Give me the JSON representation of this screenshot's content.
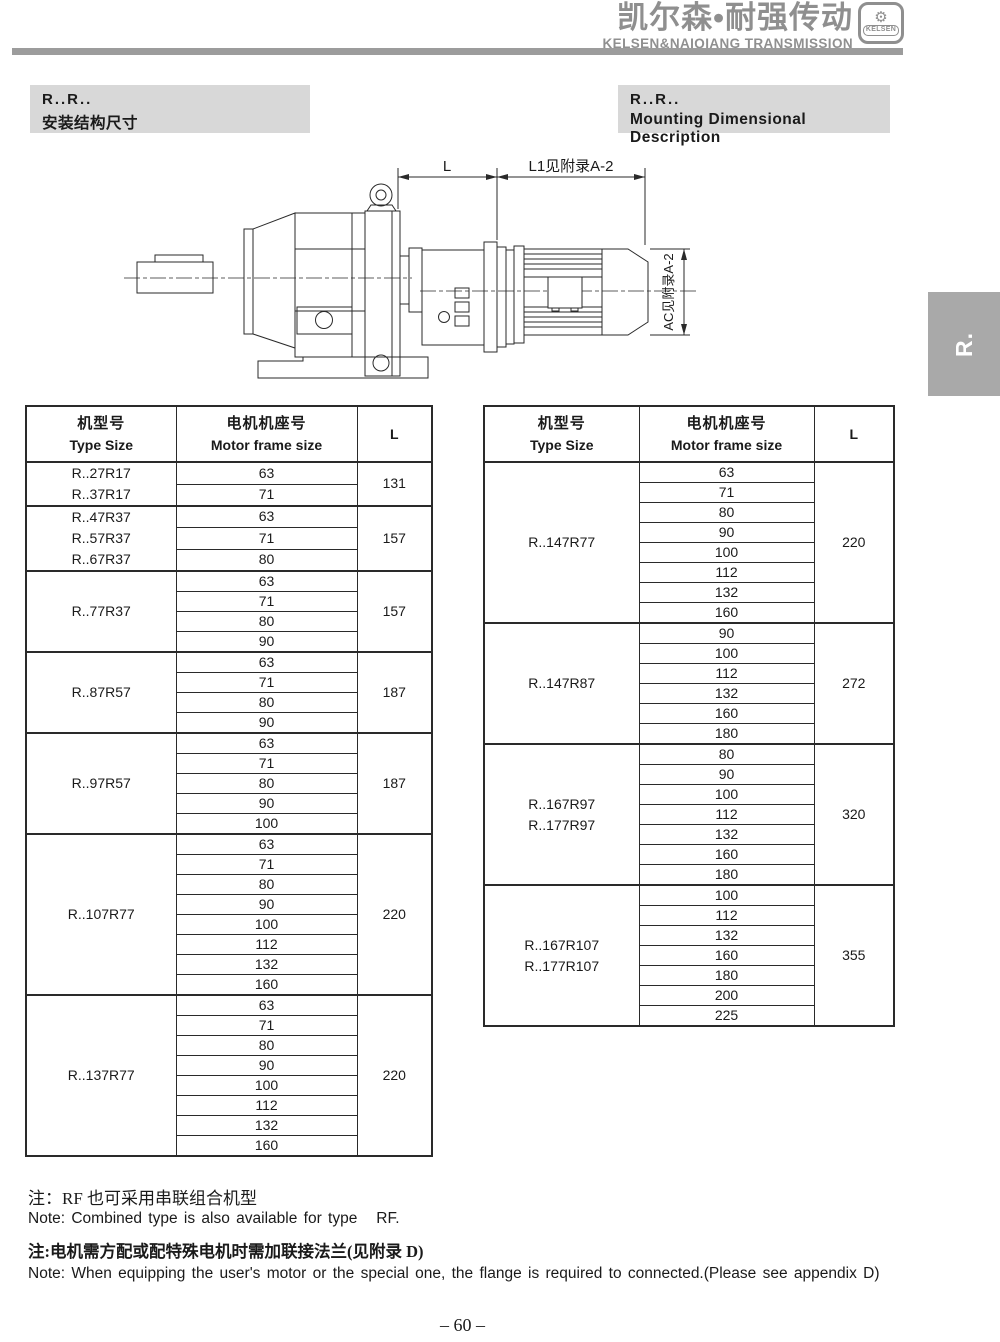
{
  "header": {
    "brand_cn": "凯尔森•耐强传动",
    "brand_en": "KELSEN&NAIQIANG TRANSMISSION",
    "logo_text": "KELSEN"
  },
  "title_left": {
    "line1": "R..R..",
    "line2": "安装结构尺寸"
  },
  "title_right": {
    "line1": "R..R..",
    "line2": "Mounting Dimensional Description"
  },
  "side_tab": {
    "label": "R."
  },
  "drawing": {
    "dim_l": "L",
    "dim_l1": "L1见附录A-2",
    "dim_ac": "AC见附录A-2"
  },
  "tables": {
    "headers": {
      "type_size_cn": "机型号",
      "type_size_en": "Type Size",
      "frame_cn": "电机机座号",
      "frame_en": "Motor frame size",
      "l": "L"
    },
    "left_groups": [
      {
        "types": [
          "R..27R17",
          "R..37R17"
        ],
        "frames": [
          "63",
          "71"
        ],
        "l": "131"
      },
      {
        "types": [
          "R..47R37",
          "R..57R37",
          "R..67R37"
        ],
        "frames": [
          "63",
          "71",
          "80"
        ],
        "l": "157"
      },
      {
        "types": [
          "R..77R37"
        ],
        "frames": [
          "63",
          "71",
          "80",
          "90"
        ],
        "l": "157"
      },
      {
        "types": [
          "R..87R57"
        ],
        "frames": [
          "63",
          "71",
          "80",
          "90"
        ],
        "l": "187"
      },
      {
        "types": [
          "R..97R57"
        ],
        "frames": [
          "63",
          "71",
          "80",
          "90",
          "100"
        ],
        "l": "187"
      },
      {
        "types": [
          "R..107R77"
        ],
        "frames": [
          "63",
          "71",
          "80",
          "90",
          "100",
          "112",
          "132",
          "160"
        ],
        "l": "220"
      },
      {
        "types": [
          "R..137R77"
        ],
        "frames": [
          "63",
          "71",
          "80",
          "90",
          "100",
          "112",
          "132",
          "160"
        ],
        "l": "220"
      }
    ],
    "right_groups": [
      {
        "types": [
          "R..147R77"
        ],
        "frames": [
          "63",
          "71",
          "80",
          "90",
          "100",
          "112",
          "132",
          "160"
        ],
        "l": "220"
      },
      {
        "types": [
          "R..147R87"
        ],
        "frames": [
          "90",
          "100",
          "112",
          "132",
          "160",
          "180"
        ],
        "l": "272"
      },
      {
        "types": [
          "R..167R97",
          "R..177R97"
        ],
        "frames": [
          "80",
          "90",
          "100",
          "112",
          "132",
          "160",
          "180"
        ],
        "l": "320"
      },
      {
        "types": [
          "R..167R107",
          "R..177R107"
        ],
        "frames": [
          "100",
          "112",
          "132",
          "160",
          "180",
          "200",
          "225"
        ],
        "l": "355"
      }
    ]
  },
  "notes": {
    "line1_cn": "注：RF 也可采用串联组合机型",
    "line1_en": "Note: Combined type is also available for type   RF.",
    "line2_cn": "注:电机需方配或配特殊电机时需加联接法兰(见附录 D)",
    "line2_en": "Note: When equipping the user's motor or the special one, the flange is required to connected.(Please see appendix D)"
  },
  "page_number": "– 60 –",
  "colors": {
    "brand_gray": "#8f8f8f",
    "header_bar": "#9c9c9c",
    "title_bg": "#d8d8d8",
    "tab_bg": "#a9a9a9",
    "line": "#2a2a2a"
  }
}
